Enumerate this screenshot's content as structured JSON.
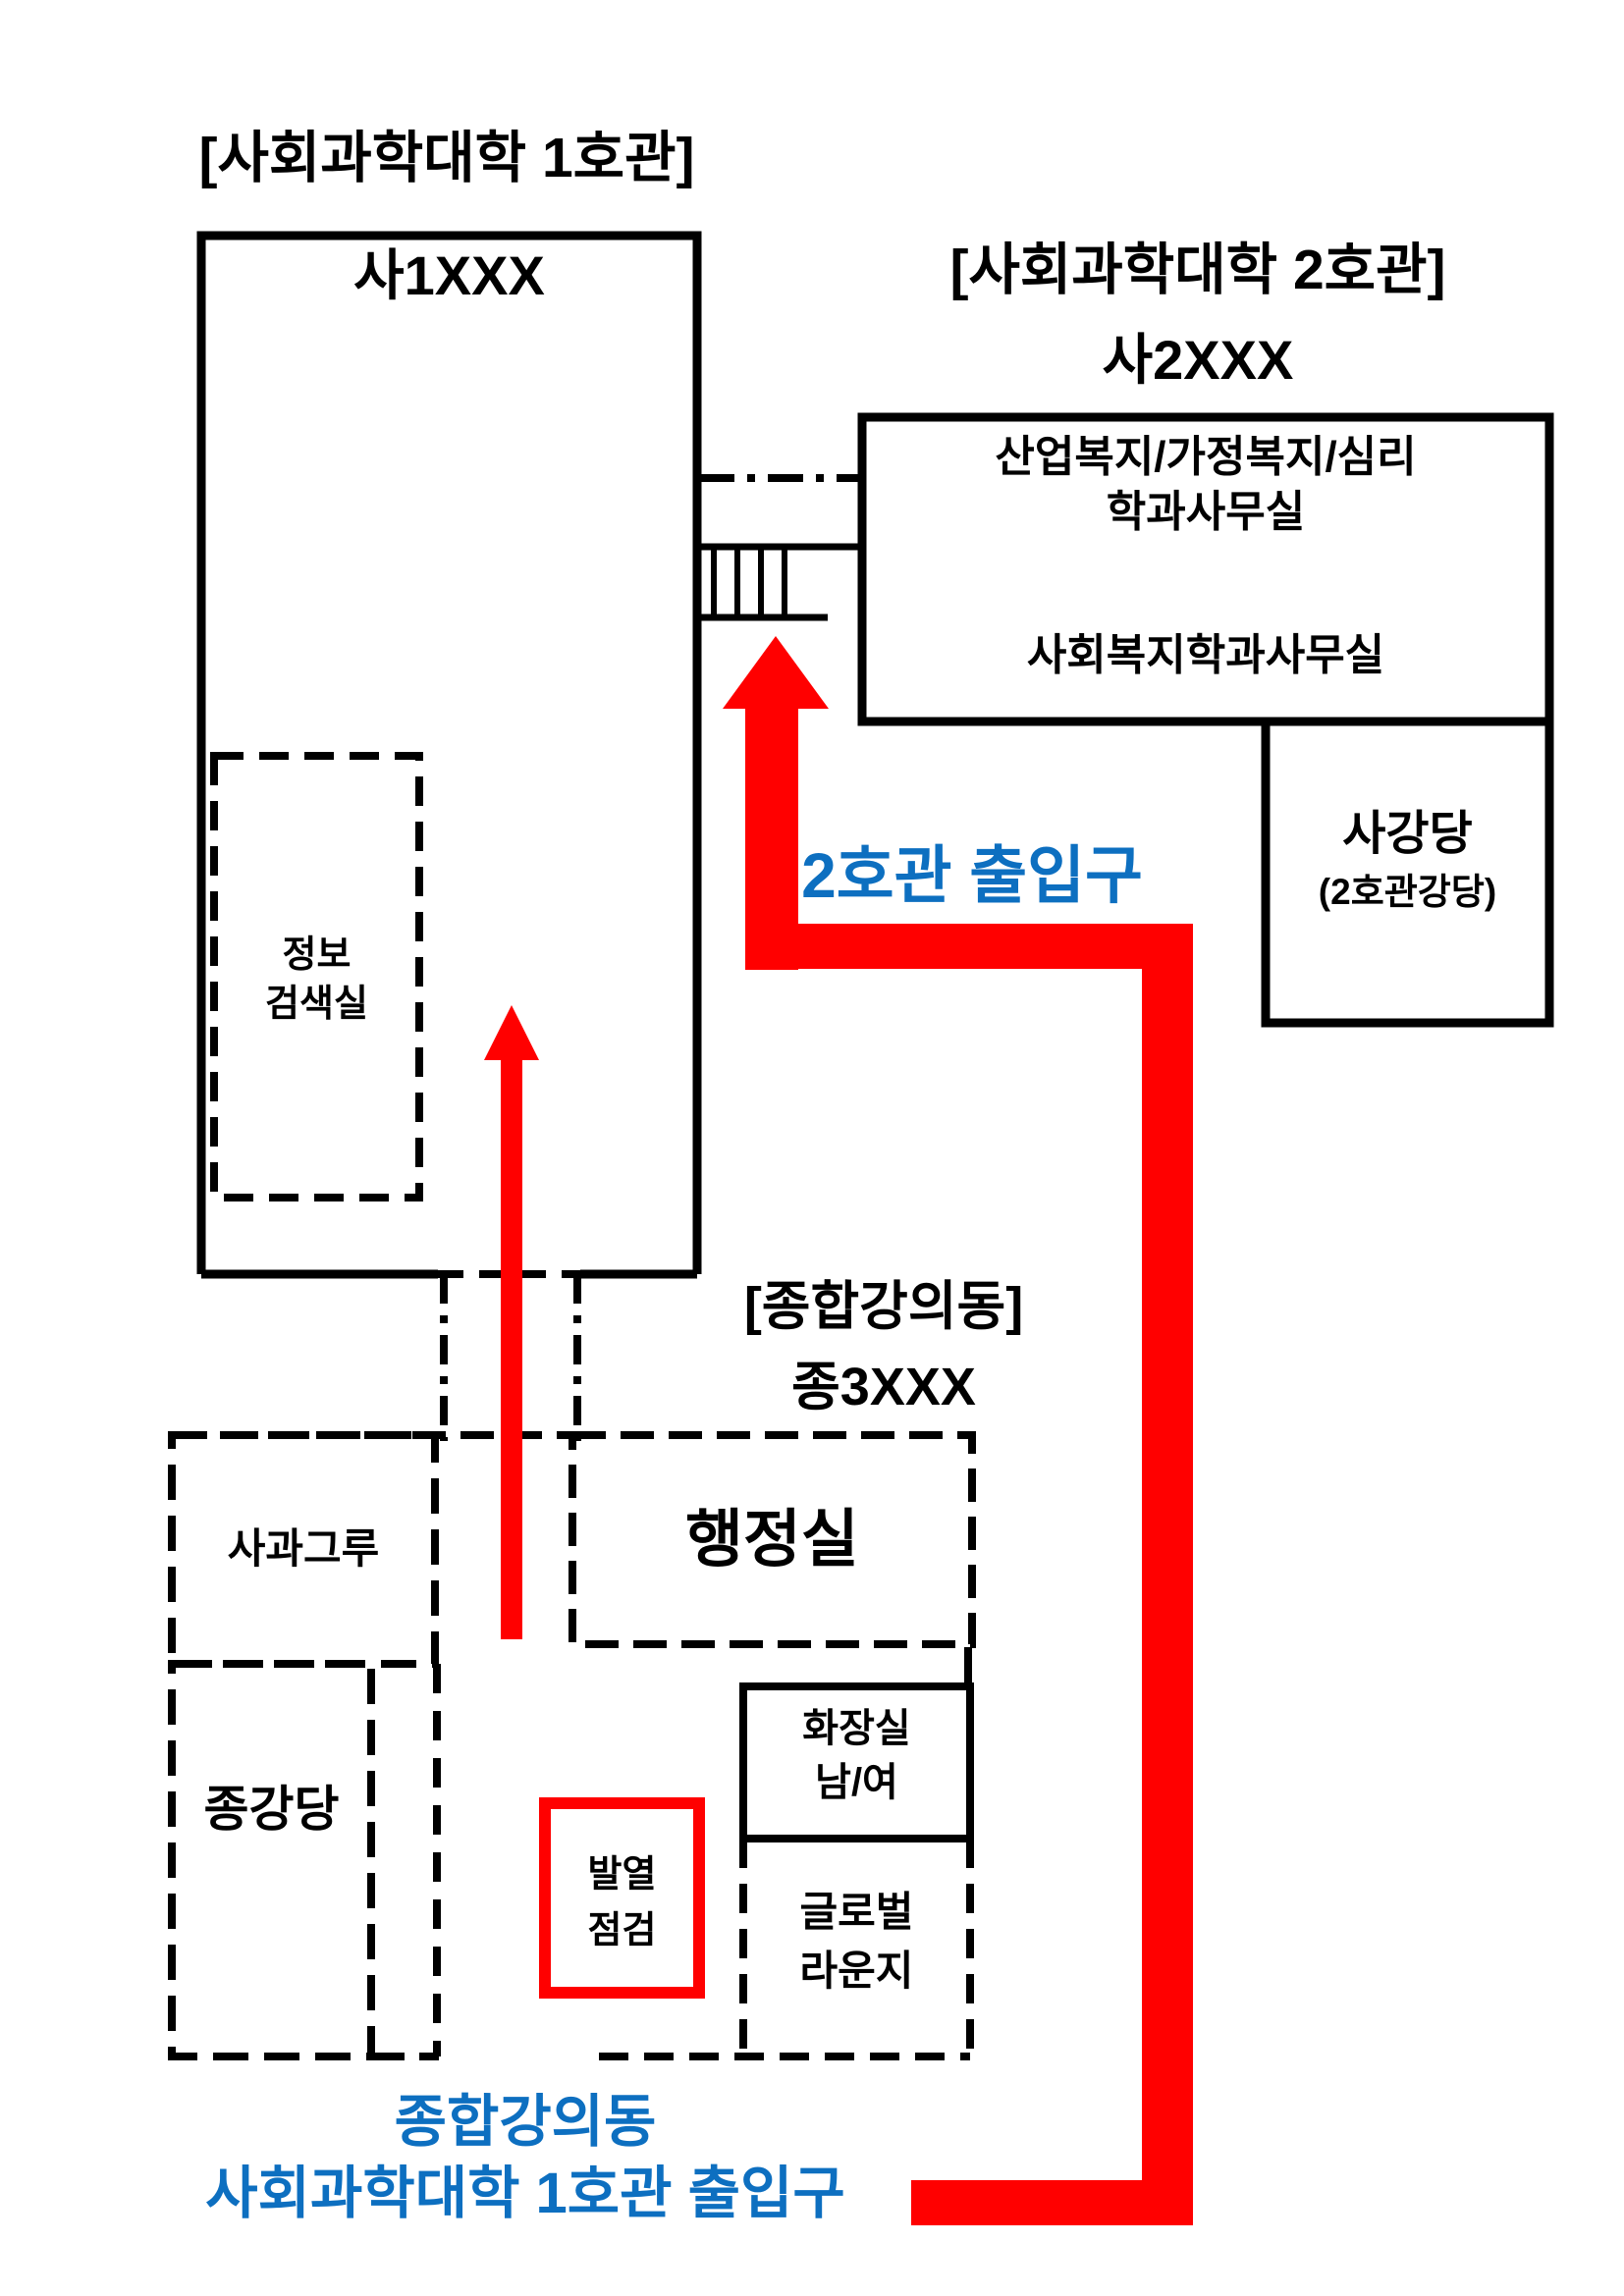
{
  "colors": {
    "accent_blue": "#0d6fc0",
    "path_red": "#ff0000",
    "line_black": "#000000"
  },
  "building1": {
    "title": "[사회과학대학 1호관]",
    "code": "사1XXX",
    "info_room": "정보\n검색실"
  },
  "building2": {
    "title": "[사회과학대학 2호관]",
    "code": "사2XXX",
    "dept_offices": "산업복지/가정복지/심리\n학과사무실",
    "welfare_office": "사회복지학과사무실",
    "auditorium": "사강당",
    "auditorium_sub": "(2호관강당)",
    "entrance_label": "2호관 출입구"
  },
  "lecture_building": {
    "title": "[종합강의동]",
    "code": "종3XXX",
    "admin_office": "행정실",
    "apple_grove_room": "사과그루",
    "auditorium": "종강당",
    "fever_check": "발열\n점검",
    "restroom": "화장실\n남/여",
    "global_lounge": "글로벌\n라운지"
  },
  "footer": {
    "entrance_label": "종합강의동\n사회과학대학 1호관 출입구"
  }
}
